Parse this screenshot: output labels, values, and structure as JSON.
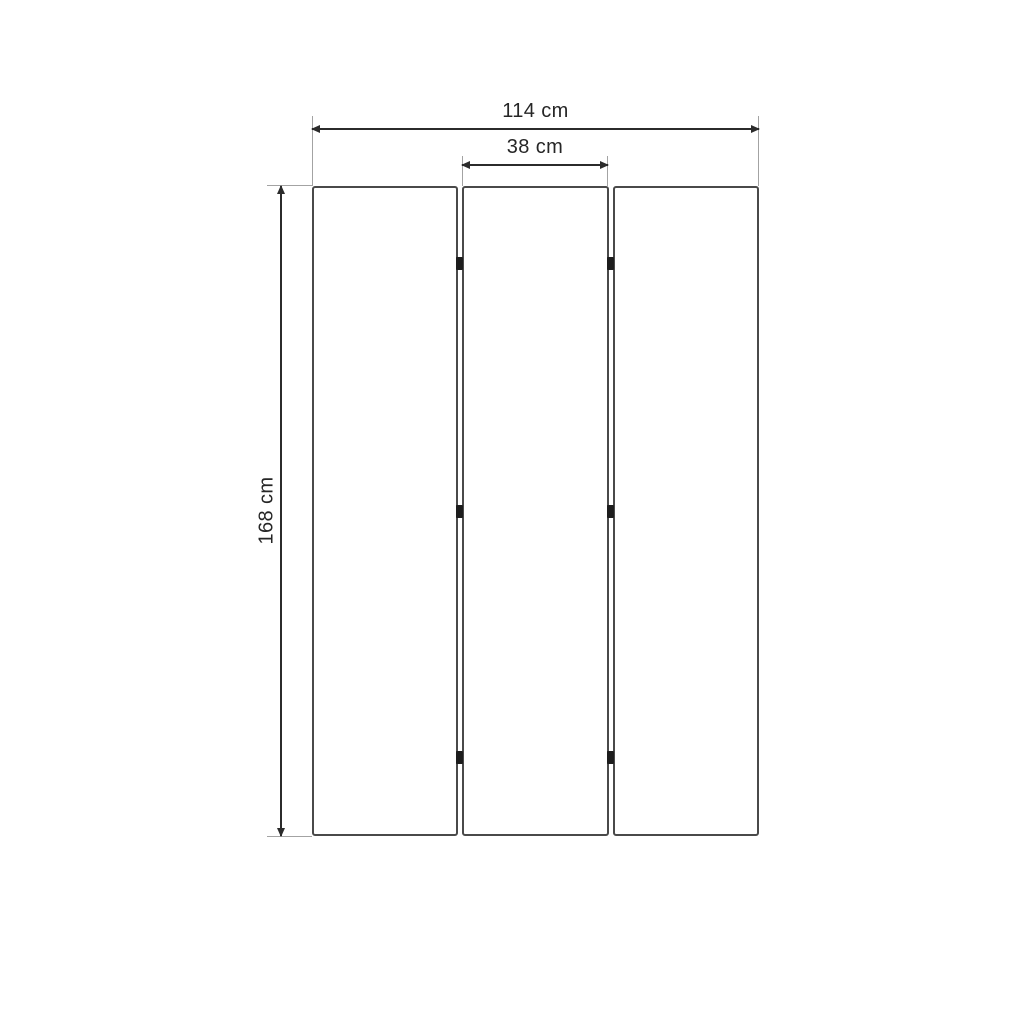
{
  "diagram": {
    "type": "dimensional-drawing",
    "subject": "three-panel folding screen, front view",
    "dimensions": {
      "total_width": {
        "label": "114 cm",
        "value": 114,
        "unit": "cm"
      },
      "panel_width": {
        "label": "38 cm",
        "value": 38,
        "unit": "cm"
      },
      "height": {
        "label": "168 cm",
        "value": 168,
        "unit": "cm"
      }
    },
    "panels": {
      "count": 3,
      "hinge_columns": 2,
      "hinges_per_column": 3
    },
    "colors": {
      "background": "#ffffff",
      "dimension_line": "#2b2b2b",
      "extension_line": "#a3a3a3",
      "panel_border": "#4a4a4a",
      "hinge": "#1d1d1d",
      "text": "#262626"
    }
  }
}
